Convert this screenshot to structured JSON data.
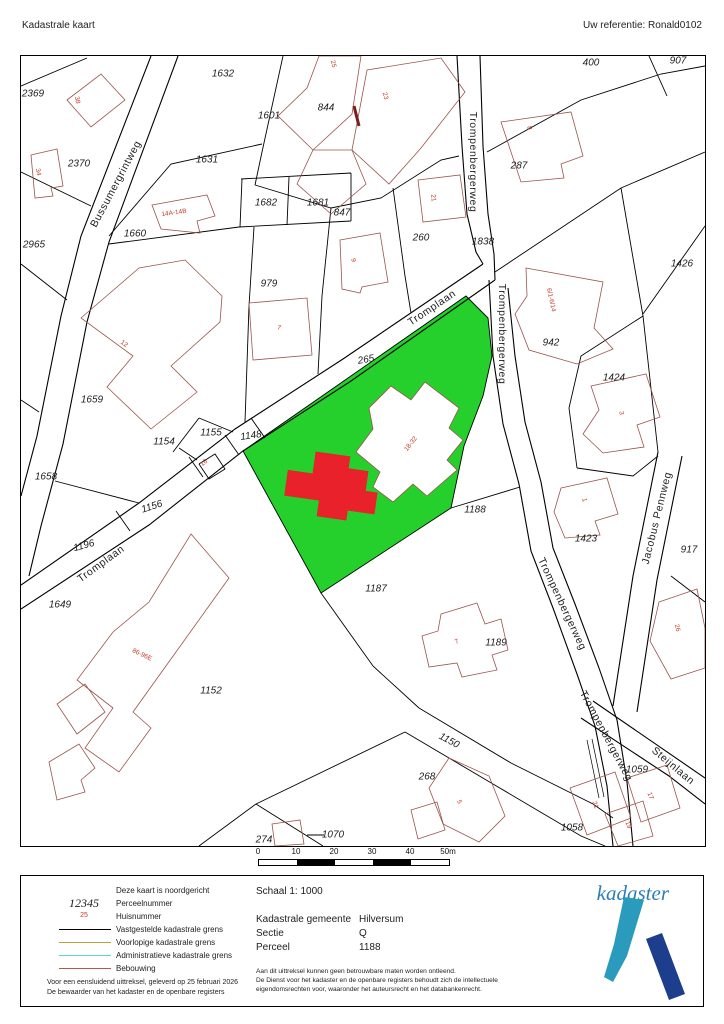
{
  "header": {
    "title": "Kadastrale kaart",
    "reference": "Uw referentie: Ronald0102"
  },
  "map": {
    "highlight_colors": {
      "parcel_green": "#25d02c",
      "building_red": "#e8212a",
      "building_outline": "#9a544c"
    },
    "parcels": [
      {
        "t": "2369",
        "x": 12,
        "y": 38
      },
      {
        "t": "1632",
        "x": 202,
        "y": 18
      },
      {
        "t": "1601",
        "x": 248,
        "y": 60
      },
      {
        "t": "844",
        "x": 305,
        "y": 52
      },
      {
        "t": "2370",
        "x": 58,
        "y": 108
      },
      {
        "t": "1631",
        "x": 186,
        "y": 104
      },
      {
        "t": "287",
        "x": 498,
        "y": 110
      },
      {
        "t": "400",
        "x": 570,
        "y": 7
      },
      {
        "t": "907",
        "x": 657,
        "y": 5
      },
      {
        "t": "1682",
        "x": 245,
        "y": 147
      },
      {
        "t": "1681",
        "x": 297,
        "y": 147
      },
      {
        "t": "1660",
        "x": 114,
        "y": 178
      },
      {
        "t": "847",
        "x": 321,
        "y": 157
      },
      {
        "t": "260",
        "x": 400,
        "y": 182
      },
      {
        "t": "1838",
        "x": 462,
        "y": 186
      },
      {
        "t": "2965",
        "x": 13,
        "y": 189
      },
      {
        "t": "979",
        "x": 248,
        "y": 228
      },
      {
        "t": "1426",
        "x": 661,
        "y": 208
      },
      {
        "t": "265",
        "x": 345,
        "y": 304,
        "r": -10
      },
      {
        "t": "942",
        "x": 530,
        "y": 287
      },
      {
        "t": "1659",
        "x": 71,
        "y": 344
      },
      {
        "t": "1424",
        "x": 593,
        "y": 322
      },
      {
        "t": "1154",
        "x": 143,
        "y": 386
      },
      {
        "t": "1155",
        "x": 190,
        "y": 377
      },
      {
        "t": "1148",
        "x": 230,
        "y": 380,
        "r": -8
      },
      {
        "t": "1658",
        "x": 25,
        "y": 421
      },
      {
        "t": "1156",
        "x": 131,
        "y": 451,
        "r": -18
      },
      {
        "t": "1188",
        "x": 454,
        "y": 454
      },
      {
        "t": "1423",
        "x": 565,
        "y": 483
      },
      {
        "t": "917",
        "x": 668,
        "y": 494
      },
      {
        "t": "1196",
        "x": 63,
        "y": 490,
        "r": -15
      },
      {
        "t": "1649",
        "x": 39,
        "y": 549
      },
      {
        "t": "1187",
        "x": 355,
        "y": 533
      },
      {
        "t": "1189",
        "x": 475,
        "y": 587
      },
      {
        "t": "1152",
        "x": 190,
        "y": 635
      },
      {
        "t": "1150",
        "x": 428,
        "y": 685,
        "r": 28
      },
      {
        "t": "268",
        "x": 406,
        "y": 721
      },
      {
        "t": "1059",
        "x": 616,
        "y": 714
      },
      {
        "t": "274",
        "x": 243,
        "y": 784
      },
      {
        "t": "1070",
        "x": 312,
        "y": 779
      },
      {
        "t": "1058",
        "x": 551,
        "y": 772
      }
    ],
    "houses": [
      {
        "t": "38",
        "x": 56,
        "y": 44,
        "r": 80
      },
      {
        "t": "34",
        "x": 17,
        "y": 116,
        "r": 80
      },
      {
        "t": "25",
        "x": 312,
        "y": 8,
        "r": 75
      },
      {
        "t": "23",
        "x": 364,
        "y": 40,
        "r": 75
      },
      {
        "t": "8",
        "x": 508,
        "y": 72,
        "r": 80
      },
      {
        "t": "14A-14B",
        "x": 153,
        "y": 157,
        "r": -8
      },
      {
        "t": "21",
        "x": 412,
        "y": 142,
        "r": 85
      },
      {
        "t": "9",
        "x": 332,
        "y": 204,
        "r": 85
      },
      {
        "t": "6/1-6/14",
        "x": 530,
        "y": 244,
        "r": 78
      },
      {
        "t": "7",
        "x": 258,
        "y": 272,
        "r": 15
      },
      {
        "t": "12",
        "x": 103,
        "y": 288,
        "r": 35
      },
      {
        "t": "3",
        "x": 600,
        "y": 357,
        "r": 80
      },
      {
        "t": "1",
        "x": 563,
        "y": 444,
        "r": 80
      },
      {
        "t": "26",
        "x": 656,
        "y": 572,
        "r": 75
      },
      {
        "t": "86-96E",
        "x": 121,
        "y": 599,
        "r": 25
      },
      {
        "t": "16",
        "x": 183,
        "y": 407,
        "r": -40,
        "s": 4.5
      },
      {
        "t": "18-32",
        "x": 390,
        "y": 388,
        "r": -52,
        "s": 7.5
      },
      {
        "t": "7",
        "x": 436,
        "y": 586,
        "r": -25,
        "s": 5
      },
      {
        "t": "5",
        "x": 438,
        "y": 746,
        "r": 70
      },
      {
        "t": "21",
        "x": 574,
        "y": 749,
        "r": 70
      },
      {
        "t": "19",
        "x": 607,
        "y": 769,
        "r": 70
      },
      {
        "t": "17",
        "x": 629,
        "y": 740,
        "r": 70
      }
    ],
    "streets": [
      {
        "t": "Bussumergrintweg",
        "x": 95,
        "y": 128,
        "r": -62
      },
      {
        "t": "Trompenbergerweg",
        "x": 452,
        "y": 106,
        "r": 90
      },
      {
        "t": "Tromplaan",
        "x": 411,
        "y": 252,
        "r": -34
      },
      {
        "t": "Trompenbergerweg",
        "x": 481,
        "y": 278,
        "r": 90
      },
      {
        "t": "Tromplaan",
        "x": 80,
        "y": 508,
        "r": -36
      },
      {
        "t": "Trompenbergerweg",
        "x": 541,
        "y": 548,
        "r": 65
      },
      {
        "t": "Trompenbergerweg",
        "x": 585,
        "y": 680,
        "r": 62
      },
      {
        "t": "Jacobus Pennweg",
        "x": 636,
        "y": 462,
        "r": -76
      },
      {
        "t": "Steijnlaan",
        "x": 652,
        "y": 710,
        "r": 40
      }
    ]
  },
  "scalebar": {
    "ticks": [
      "0",
      "10",
      "20",
      "30",
      "40",
      "50m"
    ]
  },
  "footer": {
    "legend": {
      "north_note": "Deze kaart is noordgericht",
      "items": [
        {
          "symbol": "12345",
          "label": "Perceelnummer"
        },
        {
          "symbol": "25",
          "label": "Huisnummer"
        },
        {
          "label": "Vastgestelde kadastrale grens",
          "color": "#000000"
        },
        {
          "label": "Voorlopige kadastrale grens",
          "color": "#b5a23a"
        },
        {
          "label": "Administratieve kadastrale grens",
          "color": "#5fd6c8"
        },
        {
          "label": "Bebouwing",
          "color": "#b0584e"
        }
      ],
      "note1": "Voor een eensluidend uittreksel, geleverd op 25 februari 2026",
      "note2": "De bewaarder van het kadaster en de openbare registers"
    },
    "details": {
      "scale": "Schaal 1: 1000",
      "rows": [
        {
          "label": "Kadastrale gemeente",
          "value": "Hilversum"
        },
        {
          "label": "Sectie",
          "value": "Q"
        },
        {
          "label": "Perceel",
          "value": "1188"
        }
      ],
      "disclaimer1": "Aan dit uittreksel kunnen geen betrouwbare maten worden ontleend.",
      "disclaimer2": "De Dienst voor het kadaster en de openbare registers behoudt zich de intellectuele",
      "disclaimer3": "eigendomsrechten voor, waaronder het auteursrecht en het databankenrecht."
    },
    "logo": {
      "text": "kadaster",
      "teal": "#2a9bbc",
      "blue": "#1c3e8c"
    }
  }
}
